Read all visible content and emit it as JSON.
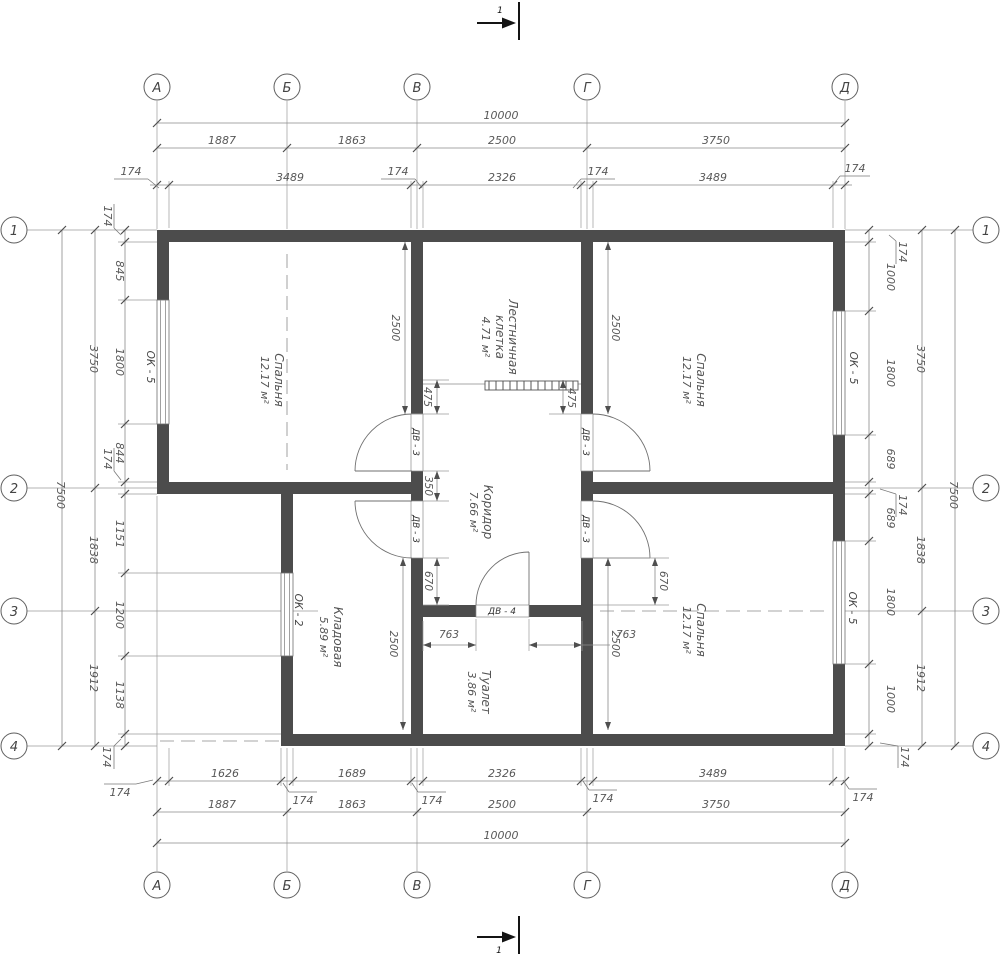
{
  "axes": {
    "h": [
      "А",
      "Б",
      "В",
      "Г",
      "Д"
    ],
    "v": [
      "1",
      "2",
      "3",
      "4"
    ]
  },
  "section": {
    "label": "1"
  },
  "dims": {
    "total_h": "10000",
    "total_v": "7500",
    "wall": "174",
    "h_axes": [
      "1887",
      "1863",
      "2500",
      "3750"
    ],
    "h_inner_top": [
      "3489",
      "2326",
      "3489"
    ],
    "h_inner_bottom": [
      "1626",
      "1689",
      "2326",
      "3489"
    ],
    "v_axes": [
      "3750",
      "1838",
      "1912"
    ],
    "v_inner_left": [
      "845",
      "1800",
      "844",
      "1151",
      "1200",
      "1138"
    ],
    "v_inner_right": [
      "1000",
      "1800",
      "689",
      "689",
      "1800",
      "1000"
    ],
    "interior": {
      "d2500": "2500",
      "d350": "350",
      "d670": "670",
      "d763": "763",
      "d475": "475"
    }
  },
  "rooms": {
    "bedroom_tl": {
      "name": "Спальня",
      "area": "12.17 м²"
    },
    "stair": {
      "line1": "Лестничная",
      "line2": "клетка",
      "area": "4.71 м²"
    },
    "bedroom_tr": {
      "name": "Спальня",
      "area": "12.17 м²"
    },
    "corridor": {
      "name": "Коридор",
      "area": "7.66 м²"
    },
    "storage": {
      "name": "Кладовая",
      "area": "5.89 м²"
    },
    "toilet": {
      "name": "Туалет",
      "area": "3.86 м²"
    },
    "bedroom_br": {
      "name": "Спальня",
      "area": "12.17 м²"
    }
  },
  "openings": {
    "window_ok5": "ОК - 5",
    "window_ok2": "ОК - 2",
    "door_dv3": "ДВ - 3",
    "door_dv4": "ДВ - 4"
  }
}
